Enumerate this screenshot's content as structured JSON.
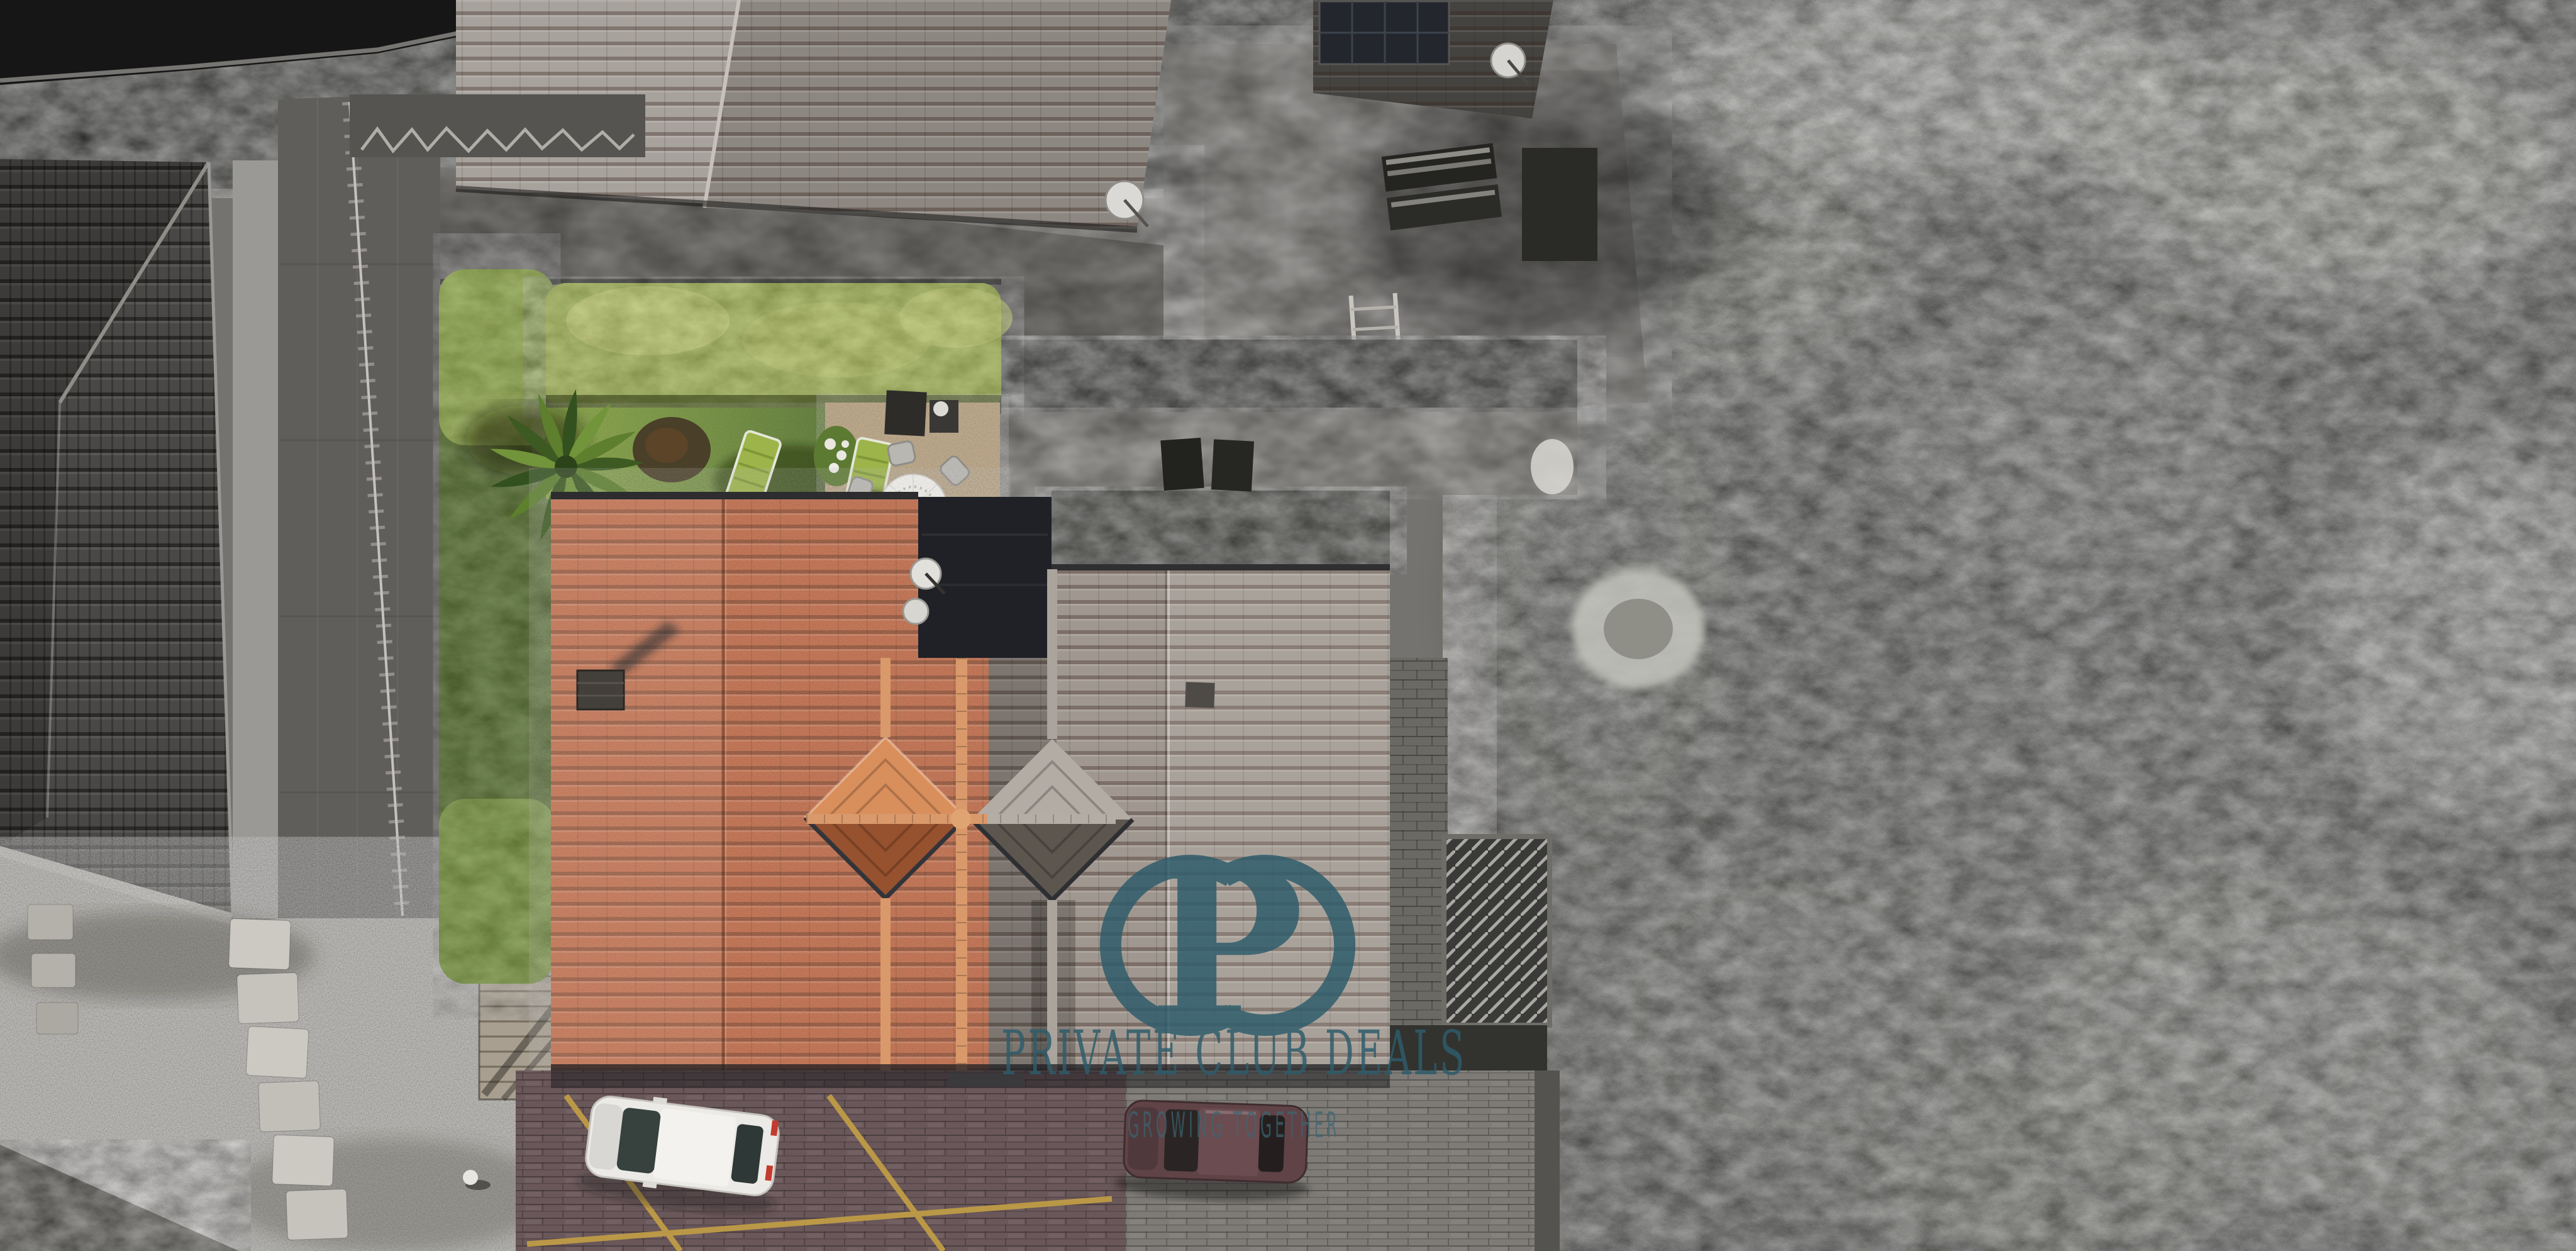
{
  "meta": {
    "kind": "aerial drone photograph",
    "effect": "selective color: subject property in color, surroundings desaturated to black and white"
  },
  "watermark": {
    "monogram": "P",
    "line1": "PRIVATE CLUB DEALS",
    "line2": "GROWING TOGETHER",
    "color": "#2e5c6b"
  },
  "scene": {
    "main_house": {
      "label": "villa with terracotta tiled roof",
      "features": [
        "chimney",
        "two pyramid diamond dormers",
        "ridge cross",
        "satellite dishes",
        "dark flat roof section"
      ]
    },
    "adjacent_roof": {
      "label": "attached desaturated roof section"
    },
    "garden": {
      "label": "private garden in color",
      "elements": [
        "tall sunlit hedge row",
        "side hedge band",
        "lawn",
        "palm tree",
        "two green sun loungers",
        "round table with white parasol and six chairs",
        "barbecue grill",
        "white flower bushes",
        "garden lamp"
      ]
    },
    "driveway": {
      "label": "brick paved driveway",
      "elements": [
        "white hatchback car",
        "dark red car",
        "yellow diagonal parking lines"
      ]
    },
    "surroundings": [
      "neighbouring hip roof (top)",
      "roof with solar panels and satellite dish",
      "flagstone courtyard with loungers and ladder",
      "large dark tiled roof (left)",
      "terrace with railing and graffiti wall",
      "gravel yard with stepping stones",
      "wood pile",
      "stone patio with palm",
      "dense tree canopy (right)",
      "curved access road (top left)",
      "glass stair canopy",
      "stone block wall"
    ]
  },
  "palette": {
    "roof_orange": "#bf6540",
    "roof_gray": "#a09890",
    "lawn_green": "#6b8a33",
    "hedge_bright": "#9db04a",
    "hedge_dark": "#49631f",
    "brick_paving": "#6a575a",
    "parking_line_yellow": "#c3a045",
    "gravel": "#a3a09a",
    "trees_gray": "#2c2c28",
    "watermark_teal": "#2e5c6b",
    "white_car": "#eceae6",
    "maroon_car": "#5f4347"
  }
}
